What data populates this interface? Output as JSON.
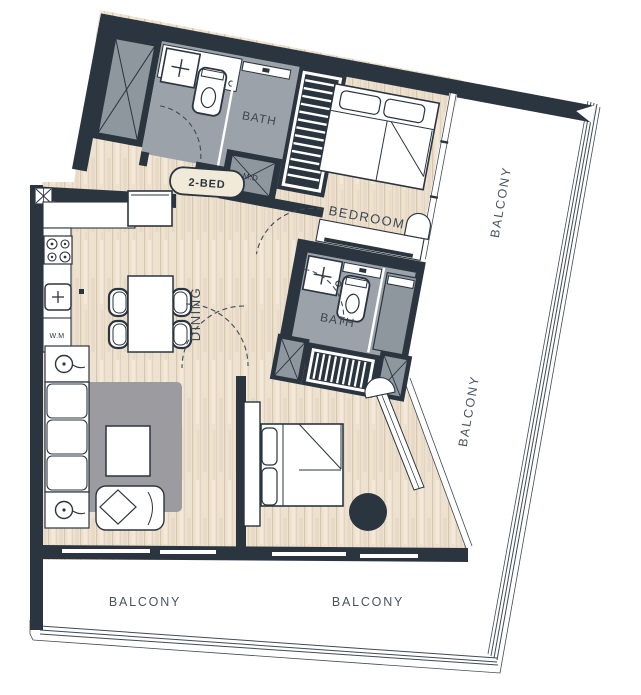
{
  "plan": {
    "unit_label": "2-BED",
    "rooms": {
      "bedroom1": "BEDROOM",
      "bath1": "BATH",
      "bath2": "BATH",
      "dining": "DINING"
    },
    "balconies": {
      "right_upper": "BALCONY",
      "right_lower": "BALCONY",
      "bottom_left": "BALCONY",
      "bottom_right": "BALCONY"
    },
    "appliances": {
      "washing_machine": "W.M",
      "mech_duct": "M.D"
    },
    "colors": {
      "wall": "#2b353f",
      "wood_floor": "#ede1d0",
      "bath_tile": "#9ba2aa",
      "shower_tile": "#8e969e",
      "rug": "#9c9ca0",
      "label_text": "#3c4852",
      "pill_fill": "#f2ead8"
    }
  }
}
